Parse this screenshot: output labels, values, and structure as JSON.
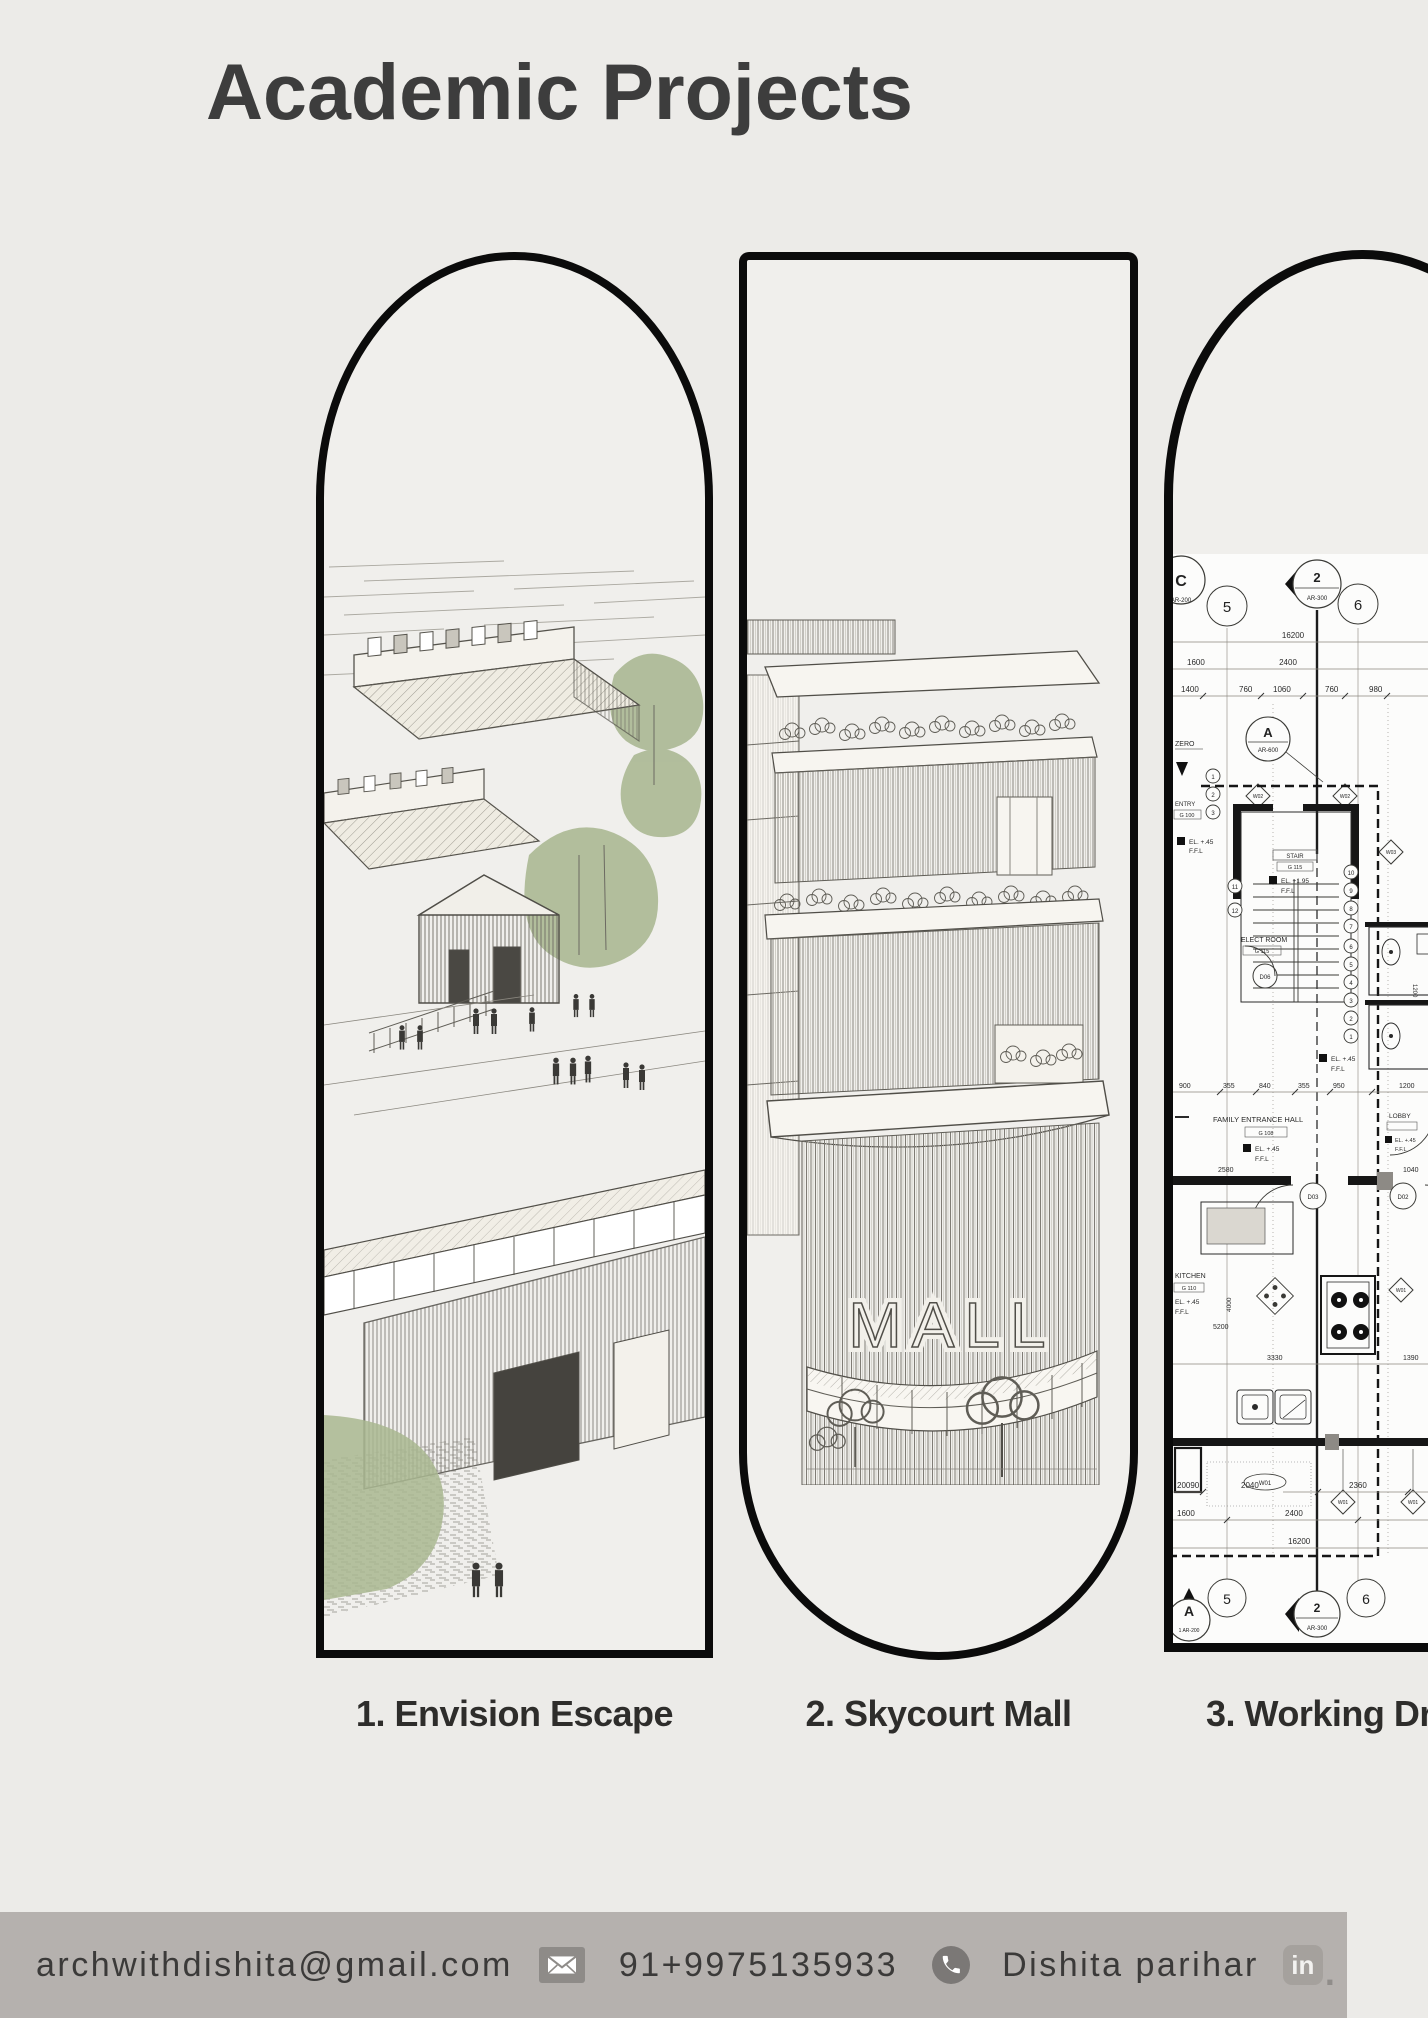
{
  "page": {
    "title": "Academic Projects"
  },
  "projects": [
    {
      "label": "1. Envision Escape"
    },
    {
      "label": "2. Skycourt Mall",
      "sign_text": "MALL"
    },
    {
      "label": "3. Working Dr"
    }
  ],
  "footer": {
    "email": "archwithdishita@gmail.com",
    "phone": "91+9975135933",
    "name": "Dishita parihar",
    "linkedin_badge": "in",
    "linkedin_suffix": "."
  },
  "colors": {
    "background": "#ecebe8",
    "frame_border": "#0b0b0b",
    "footer_bar": "#b5b1ae",
    "sketch_green": "#a9b791"
  },
  "plan": {
    "grid_bubbles_top": [
      "C",
      "5",
      "2",
      "6"
    ],
    "grid_refs_top": [
      "AR-200",
      "AR-300",
      "AR-600"
    ],
    "grid_bubble_a": "A",
    "dims_row1": [
      "16200"
    ],
    "dims_row2": [
      "1600",
      "2400"
    ],
    "dims_row3": [
      "1400",
      "760",
      "1060",
      "760",
      "980"
    ],
    "notes_left": [
      "ZERO",
      "ENTRY",
      "G 100"
    ],
    "levels": {
      "l045": "EL. +.45",
      "l195": "EL. +1.95",
      "ffl": "F.F.L"
    },
    "stair": {
      "name": "STAIR",
      "no": "G 115",
      "steps": [
        "10",
        "9",
        "8",
        "7",
        "6",
        "5",
        "4",
        "3",
        "2",
        "1",
        "11",
        "12"
      ],
      "left_tags": [
        "1",
        "2",
        "3"
      ]
    },
    "rooms": {
      "elect": {
        "name": "ELECT ROOM",
        "no": "G 115"
      },
      "family": {
        "name": "FAMILY ENTRANCE HALL",
        "no": "G 108"
      },
      "lobby": {
        "name": "LOBBY"
      },
      "kitchen": {
        "name": "KITCHEN",
        "no": "G 110"
      }
    },
    "doors": [
      "D06",
      "D03",
      "D02"
    ],
    "window_tags": [
      "W02",
      "W03",
      "W01"
    ],
    "dims_mid": [
      "900",
      "355",
      "840",
      "355",
      "950",
      "1200",
      "2580",
      "1040"
    ],
    "dims_kitchen": [
      "5200",
      "4000",
      "3330",
      "1390"
    ],
    "dims_bottom_row1": [
      "20090",
      "2040",
      "2360"
    ],
    "dims_bottom_row2": [
      "1600",
      "2400"
    ],
    "dims_bottom_row3": [
      "16200"
    ],
    "grid_bubbles_bottom": [
      "A",
      "5",
      "2",
      "6"
    ],
    "grid_refs_bottom": [
      "1 AR-200",
      "AR-300"
    ]
  }
}
